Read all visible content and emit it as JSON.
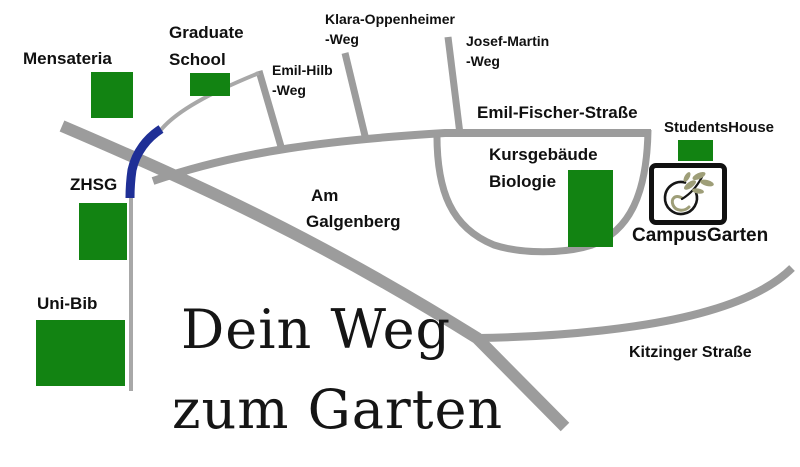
{
  "map_title": {
    "line1": "Dein Weg",
    "line2": "zum Garten"
  },
  "labels": {
    "mensateria": "Mensateria",
    "graduate_school_1": "Graduate",
    "graduate_school_2": "School",
    "klara_oppenheimer_1": "Klara-Oppenheimer",
    "klara_oppenheimer_2": "-Weg",
    "emil_hilb_1": "Emil-Hilb",
    "emil_hilb_2": "-Weg",
    "josef_martin_1": "Josef-Martin",
    "josef_martin_2": "-Weg",
    "emil_fischer": "Emil-Fischer-Straße",
    "students_house": "StudentsHouse",
    "kursgebaeude_1": "Kursgebäude",
    "kursgebaeude_2": "Biologie",
    "campus_garten": "CampusGarten",
    "zhsg": "ZHSG",
    "uni_bib": "Uni-Bib",
    "am_galgenberg_1": "Am",
    "am_galgenberg_2": "Galgenberg",
    "kitzinger": "Kitzinger Straße"
  },
  "colors": {
    "building_green": "#128312",
    "road_gray": "#9c9c9c",
    "road_light_gray": "#a8a8a8",
    "highlight_blue": "#1f2f96",
    "logo_leaf_olive": "#9e9e78",
    "logo_black": "#161616",
    "text_black": "#101010"
  },
  "legend": {
    "map_type": "hand-drawn campus wayfinding map",
    "highlighted_path": "blue curve between ZHSG junction and Graduate School path"
  }
}
